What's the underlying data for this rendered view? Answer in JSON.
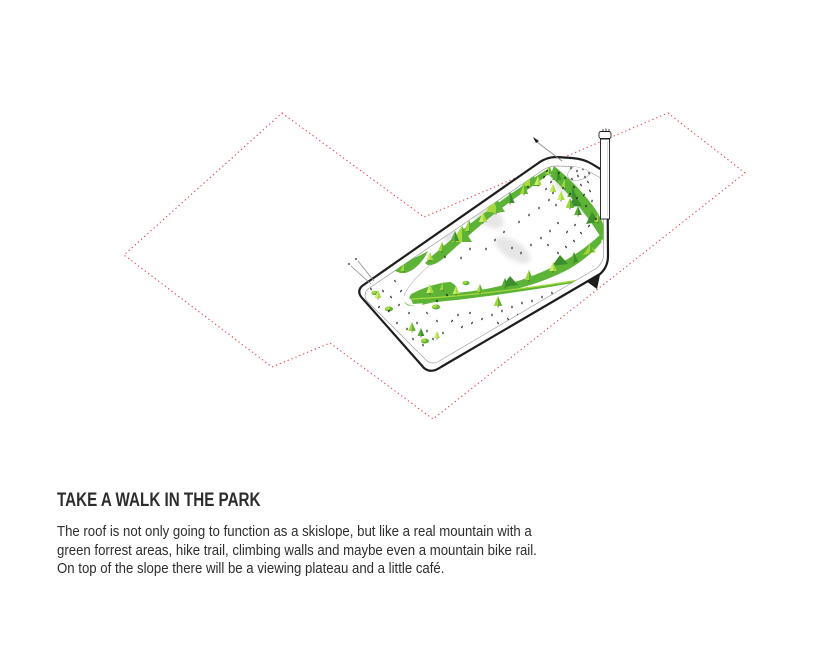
{
  "meta": {
    "width": 815,
    "height": 668
  },
  "text": {
    "heading": "TAKE A WALK IN THE PARK",
    "body_lines": [
      "The roof is not only going to function as a skislope, but like a real mountain with a",
      "green forrest areas, hike trail, climbing walls and maybe even a mountain bike rail.",
      "On top of the slope there will be a viewing plateau and a little café."
    ]
  },
  "colors": {
    "background": "#ffffff",
    "text": "#2e2d2c",
    "site_outline": "#e8414c",
    "building_outline": "#1d1d1b",
    "inner_line": "#9d9d9c",
    "green_xlight": "#cdeb71",
    "green_light": "#a8d93e",
    "green_mid": "#5cb335",
    "green_dark": "#3c8f2c",
    "slope_gray": "#d6d6d6",
    "figure_black": "#1a1a1a"
  },
  "illustration": {
    "site_boundary_points": [
      [
        282,
        113
      ],
      [
        424,
        217
      ],
      [
        668,
        113
      ],
      [
        745,
        173
      ],
      [
        433,
        419
      ],
      [
        330,
        343
      ],
      [
        272,
        367
      ],
      [
        124,
        255
      ]
    ],
    "gray_patches": [
      [
        566,
        186,
        14,
        8,
        33
      ],
      [
        486,
        215,
        20,
        10,
        33
      ],
      [
        513,
        250,
        20,
        9,
        33
      ],
      [
        449,
        235,
        13,
        7,
        33
      ]
    ],
    "trees": [
      [
        549,
        174,
        9,
        "m"
      ],
      [
        557,
        180,
        11,
        "d"
      ],
      [
        565,
        188,
        10,
        "m"
      ],
      [
        572,
        197,
        11,
        "d"
      ],
      [
        561,
        200,
        9,
        "l"
      ],
      [
        553,
        192,
        8,
        "l"
      ],
      [
        570,
        208,
        10,
        "m"
      ],
      [
        578,
        215,
        9,
        "d"
      ],
      [
        598,
        222,
        9,
        "m"
      ],
      [
        605,
        230,
        8,
        "d"
      ],
      [
        538,
        185,
        9,
        "l"
      ],
      [
        524,
        194,
        10,
        "m"
      ],
      [
        510,
        203,
        11,
        "d"
      ],
      [
        496,
        213,
        9,
        "m"
      ],
      [
        483,
        222,
        10,
        "l"
      ],
      [
        469,
        231,
        11,
        "m"
      ],
      [
        455,
        241,
        10,
        "d"
      ],
      [
        442,
        251,
        9,
        "m"
      ],
      [
        430,
        260,
        8,
        "l"
      ],
      [
        590,
        252,
        9,
        "m"
      ],
      [
        574,
        262,
        10,
        "d"
      ],
      [
        553,
        271,
        9,
        "l"
      ],
      [
        529,
        280,
        10,
        "m"
      ],
      [
        505,
        287,
        9,
        "d"
      ],
      [
        480,
        292,
        8,
        "m"
      ],
      [
        456,
        294,
        8,
        "l"
      ],
      [
        498,
        306,
        10,
        "m"
      ],
      [
        443,
        290,
        8,
        "m"
      ],
      [
        430,
        293,
        9,
        "l"
      ],
      [
        396,
        264,
        8,
        "l"
      ],
      [
        404,
        271,
        9,
        "m"
      ],
      [
        378,
        298,
        8,
        "l"
      ],
      [
        412,
        331,
        9,
        "m"
      ],
      [
        421,
        336,
        8,
        "d"
      ],
      [
        437,
        338,
        7,
        "l"
      ]
    ],
    "bushes": [
      [
        389,
        309,
        4
      ],
      [
        436,
        307,
        4
      ],
      [
        425,
        341,
        4
      ],
      [
        375,
        293,
        3.5
      ],
      [
        466,
        283,
        3.5
      ]
    ],
    "figures": [
      [
        541,
        167
      ],
      [
        547,
        171
      ],
      [
        544,
        177
      ],
      [
        551,
        182
      ],
      [
        546,
        189
      ],
      [
        553,
        193
      ],
      [
        549,
        200
      ],
      [
        556,
        205
      ],
      [
        571,
        168
      ],
      [
        577,
        171
      ],
      [
        583,
        169
      ],
      [
        589,
        173
      ],
      [
        585,
        177
      ],
      [
        578,
        176
      ],
      [
        572,
        179
      ],
      [
        588,
        182
      ],
      [
        581,
        185
      ],
      [
        574,
        187
      ],
      [
        590,
        191
      ],
      [
        584,
        195
      ],
      [
        577,
        198
      ],
      [
        570,
        194
      ],
      [
        563,
        188
      ],
      [
        565,
        178
      ],
      [
        559,
        173
      ],
      [
        592,
        201
      ],
      [
        586,
        206
      ],
      [
        536,
        167
      ],
      [
        531,
        173
      ],
      [
        505,
        183
      ],
      [
        517,
        177
      ],
      [
        528,
        187
      ],
      [
        494,
        191
      ],
      [
        482,
        199
      ],
      [
        469,
        208
      ],
      [
        457,
        219
      ],
      [
        446,
        228
      ],
      [
        496,
        173
      ],
      [
        463,
        197
      ],
      [
        474,
        190
      ],
      [
        452,
        210
      ],
      [
        441,
        220
      ],
      [
        488,
        181
      ],
      [
        519,
        222
      ],
      [
        529,
        215
      ],
      [
        539,
        208
      ],
      [
        512,
        248
      ],
      [
        521,
        253
      ],
      [
        531,
        245
      ],
      [
        541,
        238
      ],
      [
        550,
        231
      ],
      [
        558,
        223
      ],
      [
        548,
        245
      ],
      [
        558,
        253
      ],
      [
        566,
        247
      ],
      [
        574,
        241
      ],
      [
        581,
        233
      ],
      [
        589,
        226
      ],
      [
        596,
        219
      ],
      [
        567,
        232
      ],
      [
        575,
        225
      ],
      [
        504,
        232
      ],
      [
        495,
        240
      ],
      [
        486,
        249
      ],
      [
        470,
        249
      ],
      [
        461,
        258
      ],
      [
        445,
        257
      ],
      [
        372,
        263
      ],
      [
        366,
        273
      ],
      [
        379,
        277
      ],
      [
        387,
        271
      ],
      [
        395,
        281
      ],
      [
        383,
        291
      ],
      [
        371,
        289
      ],
      [
        391,
        297
      ],
      [
        401,
        291
      ],
      [
        379,
        307
      ],
      [
        389,
        311
      ],
      [
        399,
        305
      ],
      [
        409,
        313
      ],
      [
        397,
        323
      ],
      [
        385,
        321
      ],
      [
        407,
        329
      ],
      [
        417,
        323
      ],
      [
        427,
        331
      ],
      [
        413,
        339
      ],
      [
        423,
        345
      ],
      [
        433,
        339
      ],
      [
        443,
        333
      ],
      [
        437,
        321
      ],
      [
        427,
        313
      ],
      [
        437,
        301
      ],
      [
        447,
        295
      ],
      [
        362,
        291
      ],
      [
        452,
        321
      ],
      [
        462,
        327
      ],
      [
        472,
        323
      ],
      [
        482,
        319
      ],
      [
        470,
        313
      ],
      [
        458,
        315
      ],
      [
        492,
        315
      ],
      [
        502,
        311
      ],
      [
        512,
        307
      ],
      [
        522,
        303
      ],
      [
        532,
        301
      ],
      [
        542,
        297
      ],
      [
        552,
        293
      ],
      [
        562,
        291
      ],
      [
        572,
        289
      ],
      [
        582,
        287
      ],
      [
        498,
        323
      ],
      [
        508,
        319
      ],
      [
        518,
        315
      ],
      [
        528,
        311
      ],
      [
        538,
        307
      ],
      [
        548,
        303
      ],
      [
        558,
        299
      ],
      [
        568,
        297
      ],
      [
        578,
        293
      ],
      [
        566,
        305
      ],
      [
        576,
        301
      ],
      [
        586,
        291
      ],
      [
        584,
        281
      ],
      [
        590,
        279
      ],
      [
        594,
        285
      ]
    ]
  }
}
